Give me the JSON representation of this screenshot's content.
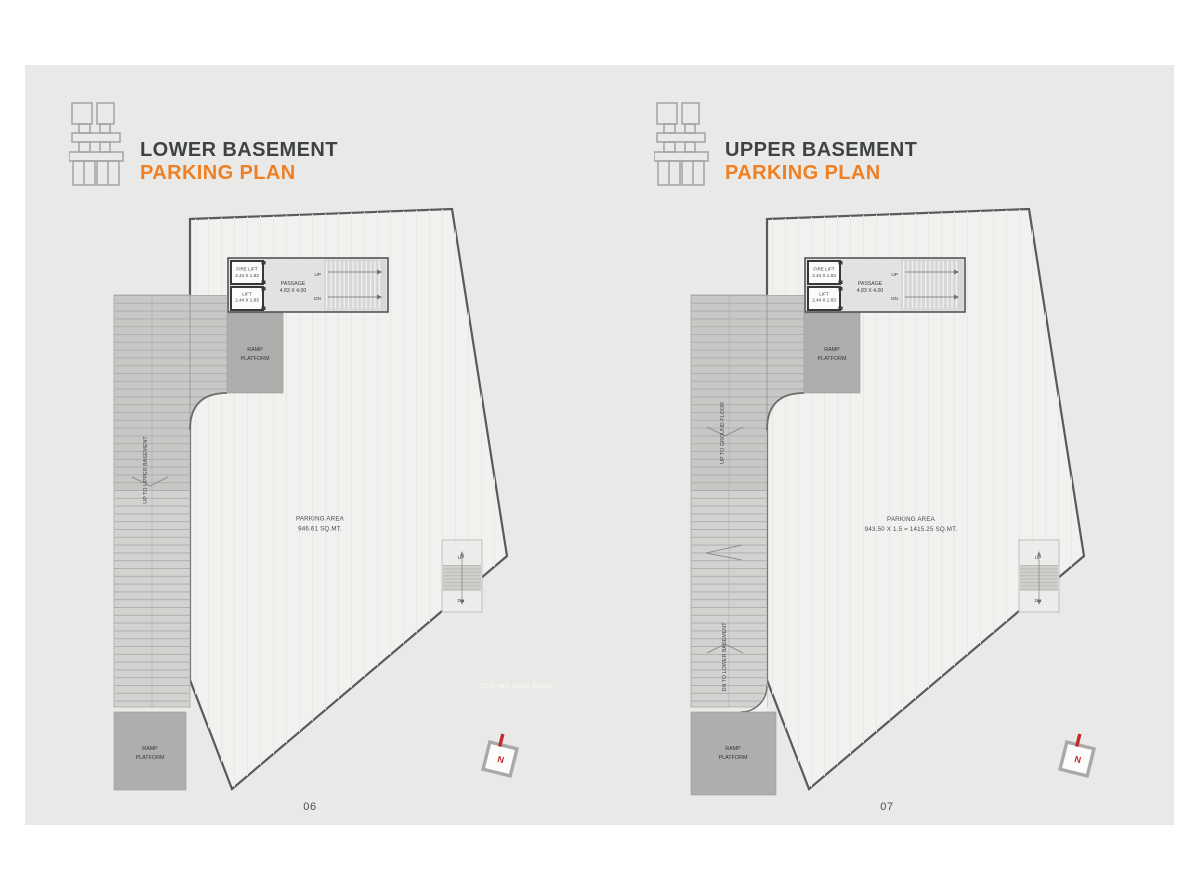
{
  "sheet": {
    "background": "#ffffff",
    "panel_color": "#e9eae7",
    "accent_color": "#ef7f22",
    "title_color": "#3f4245",
    "compass_color": "#c3292e",
    "headers": [
      {
        "line1": "LOWER BASEMENT",
        "line2": "PARKING PLAN"
      },
      {
        "line1": "UPPER BASEMENT",
        "line2": "PARKING PLAN"
      }
    ]
  },
  "plans": [
    {
      "name": "lower-basement-parking-plan",
      "page_number": "06",
      "parking_area": {
        "line1": "PARKING AREA",
        "line2": "946.61  SQ.MT."
      },
      "ramp_labels": {
        "up": "UP TO UPPER BASEMENT"
      },
      "road_label": "12.00 MT. WIDE ROAD"
    },
    {
      "name": "upper-basement-parking-plan",
      "page_number": "07",
      "parking_area": {
        "line1": "PARKING AREA",
        "line2": "943.50 X 1.5 = 1415.25 SQ.MT."
      },
      "ramp_labels": {
        "up": "UP TO GROUND FLOOR",
        "down": "DN TO LOWER BASEMENT"
      }
    }
  ],
  "shared_labels": {
    "fire_lift": "FIRE LIFT",
    "fire_lift_dim": "2.44 X 1.83",
    "lift": "LIFT",
    "lift_dim": "2.44 X 1.83",
    "passage": "PASSAGE",
    "passage_dim": "4.83 X 4.00",
    "up": "UP",
    "dn": "DN",
    "ramp": "RAMP",
    "platform": "PLATFORM",
    "north": "N"
  },
  "icons": {
    "logo": "building-stack-icon",
    "compass": "north-compass-icon"
  }
}
